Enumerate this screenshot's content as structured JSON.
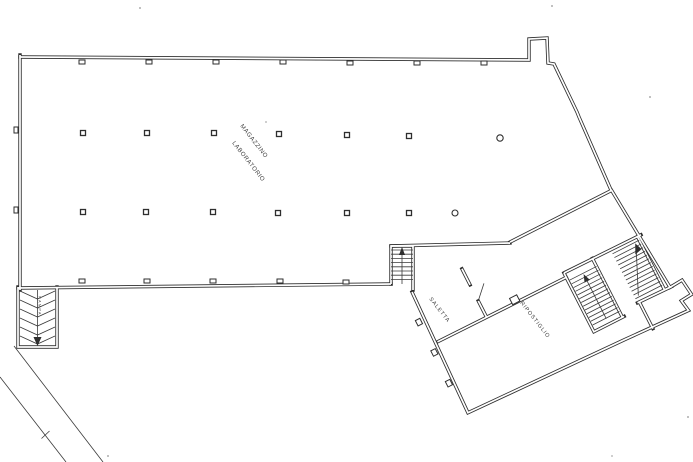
{
  "labels": {
    "magazzino": "MAGAZZINO",
    "laboratorio": "LABORATORIO",
    "saletta": "SALETTA",
    "ripostiglio": "RIPOSTIGLIO",
    "rampa": "RAMPA"
  },
  "colors": {
    "ink": "#2e2e2e",
    "paper": "#ffffff",
    "faint_line": "#ababab"
  }
}
